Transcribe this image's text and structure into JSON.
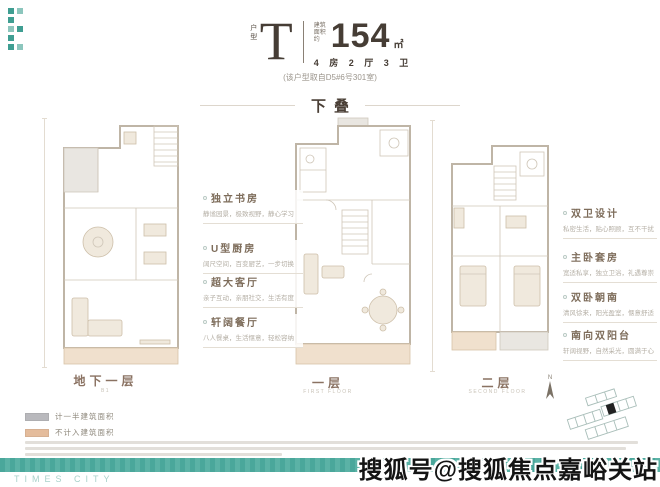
{
  "header": {
    "type_label": "户型",
    "type_letter": "T",
    "area_prefix": "建筑面积约",
    "area_value": "154",
    "area_unit": "㎡",
    "layout": "4 房 2 厅 3 卫",
    "source_note": "(该户型取自D5#6号301室)"
  },
  "section_title": "下叠",
  "floors": [
    {
      "label": "地下一层",
      "sublabel": "B1"
    },
    {
      "label": "一层",
      "sublabel": "FIRST FLOOR"
    },
    {
      "label": "二层",
      "sublabel": "SECOND FLOOR"
    }
  ],
  "features_left": [
    {
      "title": "独立书房",
      "desc": "静谧园景，极致视野，静心学习"
    },
    {
      "title": "U型厨房",
      "desc": "阔尺空间，百变厨艺，一步切换"
    },
    {
      "title": "超大客厅",
      "desc": "亲子互动，亲朋社交，生活有度"
    },
    {
      "title": "轩阔餐厅",
      "desc": "八人餐桌，生活惬意，轻松容纳"
    }
  ],
  "features_right": [
    {
      "title": "双卫设计",
      "desc": "私密生活，贴心照顾，互不干扰"
    },
    {
      "title": "主卧套房",
      "desc": "宽适私享，独立卫浴，礼遇尊崇"
    },
    {
      "title": "双卧朝南",
      "desc": "清风徐来，阳光盈室，惬意舒适"
    },
    {
      "title": "南向双阳台",
      "desc": "轩阔视野，自然采光，圆满于心"
    }
  ],
  "legend": [
    {
      "label": "计一半建筑面积",
      "color": "#b9b9bd"
    },
    {
      "label": "不计入建筑面积",
      "color": "#e4bc9c"
    }
  ],
  "compass_label": "N",
  "footer_brand": "TIMES CITY",
  "watermark": "搜狐号@搜狐焦点嘉峪关站",
  "colors": {
    "accent_teal": "#4aa79b",
    "title_brown": "#4a3f36",
    "feature_brown": "#7d6c5a"
  }
}
